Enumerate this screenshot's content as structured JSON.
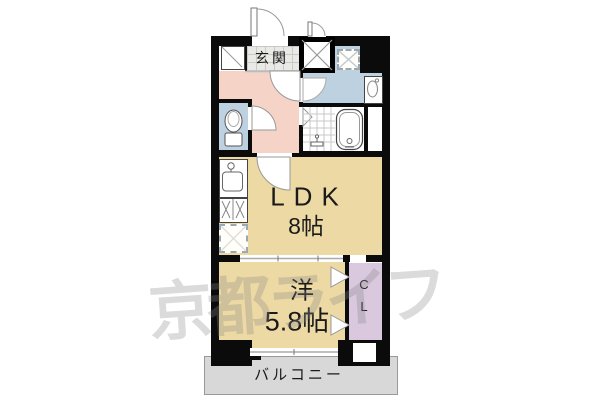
{
  "plan": {
    "type": "japanese-apartment-floorplan",
    "watermark": {
      "text": "京都ライフ",
      "color": "#bbbbbb"
    },
    "rooms": {
      "genkan": {
        "label": "玄関"
      },
      "ldk": {
        "label": "LDK",
        "size": "8帖"
      },
      "western": {
        "label": "洋",
        "size": "5.8帖"
      },
      "closet": {
        "label": "CL"
      },
      "balcony": {
        "label": "バルコニー"
      }
    },
    "fixtures": [
      "entrance-door",
      "shoe-cabinet",
      "pipe-space",
      "washing-machine-space",
      "washbasin",
      "toilet",
      "unit-bath",
      "bathtub",
      "shower-faucet",
      "kitchen-sink",
      "gas-stove",
      "refrigerator-space",
      "sliding-partition",
      "closet-folding-door",
      "balcony-window"
    ],
    "colors": {
      "wall": "#0b0b0b",
      "hallway_pink": "#f6d3c7",
      "sanitary_blue": "#bdd1e0",
      "ldk_tan": "#ecd9a3",
      "closet_lavender": "#d9c8de",
      "genkan_tile": "#e9e9e6",
      "balcony_gray": "#d8d8d8"
    }
  }
}
